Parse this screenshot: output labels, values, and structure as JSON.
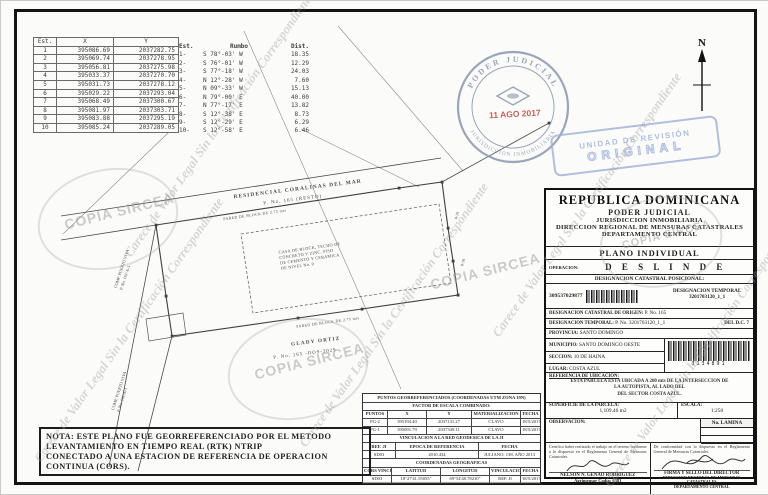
{
  "watermark": {
    "copia": "COPIA SIRCEA",
    "legal": "Carece de Valor Legal Sin la Certificación Correspondiente"
  },
  "north_label": "N",
  "coord_table": {
    "headers": [
      "Est.",
      "X",
      "Y"
    ],
    "rows": [
      [
        "1",
        "395086.69",
        "2037282.75"
      ],
      [
        "2",
        "395069.74",
        "2037278.95"
      ],
      [
        "3",
        "395056.81",
        "2037275.98"
      ],
      [
        "4",
        "395033.37",
        "2037270.70"
      ],
      [
        "5",
        "395031.73",
        "2037278.12"
      ],
      [
        "6",
        "395029.22",
        "2037293.04"
      ],
      [
        "7",
        "395068.49",
        "2037300.67"
      ],
      [
        "8",
        "395081.97",
        "2037303.71"
      ],
      [
        "9",
        "395083.88",
        "2037295.19"
      ],
      [
        "10",
        "395085.24",
        "2037289.05"
      ]
    ]
  },
  "bearing_table": {
    "headers": [
      "Est.",
      "Rumbo",
      "Dist."
    ],
    "rows": [
      [
        "1-",
        "S 78°-03' W",
        "18.35"
      ],
      [
        "2-",
        "S 76°-01' W",
        "12.29"
      ],
      [
        "3-",
        "S 77°-18' W",
        "24.03"
      ],
      [
        "4-",
        "N 12°-28' W",
        "7.60"
      ],
      [
        "5-",
        "N 09°-33' W",
        "15.13"
      ],
      [
        "6-",
        "N 79°-00' E",
        "40.00"
      ],
      [
        "7-",
        "N 77°-17' E",
        "13.82"
      ],
      [
        "8-",
        "S 12°-38' E",
        "8.73"
      ],
      [
        "9-",
        "S 12°-29' E",
        "6.29"
      ],
      [
        "10-",
        "S 12°-58' E",
        "6.46"
      ]
    ]
  },
  "stamps": {
    "round_top": "PODER JUDICIAL",
    "round_bottom": "JURISDICCION INMOBILIARIA",
    "round_date": "11 AGO 2017",
    "revision_line1": "UNIDAD DE REVISIÓN",
    "revision_line2": "ORIGINAL"
  },
  "drawing": {
    "residencial": "RESIDENCIAL CORALINAS DEL MAR",
    "resto": "P. No. 165 (RESTO)",
    "pared_top": "PARED DE BLOCK DE 2.75 mts",
    "pared_bottom": "PARED DE BLOCK DE 2.75 mts",
    "casa_lines": [
      "CASA DE BLOCK, TECHO DE",
      "CONCRETO Y ZINC, PISO",
      "DE CEMENTO Y CERAMICA",
      "DE NIVEL No. 0"
    ],
    "owner": "GLADY ORTIZ",
    "owner_parcel": "P. No. 165 -DOS-3029",
    "neighbor1": "COMP. PUERTO VIVA",
    "neighbor1_parcel": "P. No. 161-A-3",
    "neighbor2": "COMP. PUERTO VIVA",
    "neighbor2_parcel": "P. No. 161-A-1",
    "vertex1": "8-18",
    "vertex2": "8-19"
  },
  "panel": {
    "header_lines": [
      "REPUBLICA  DOMINICANA",
      "PODER  JUDICIAL",
      "JURISDICCION INMOBILIARIA",
      "DIRECCION REGIONAL DE MENSURAS CATASTRALES",
      "DEPARTAMENTO CENTRAL"
    ],
    "plano": "PLANO INDIVIDUAL",
    "operacion_label": "OPERACION:",
    "operacion_value": "D E S L I N D E",
    "desig_pos_label": "DESIGNACION CATASTRAL POSICIONAL:",
    "desig_pos_number": "309537029877",
    "desig_temp_label": "DESIGNACION TEMPORAL",
    "desig_temp_value": "3201703120_1_1",
    "origen_label": "DESIGNACION CATASTRAL DE ORIGEN:",
    "origen_value": "P. No. 165",
    "temporal_label": "DESIGNACION TEMPORAL:",
    "temporal_value": "P. No. 3201703120_1_1",
    "temporal_extra": "DEL D.C. 7",
    "provincia_label": "PROVINCIA:",
    "provincia_value": "SANTO DOMINGO",
    "municipio_label": "MUNICIPIO:",
    "municipio_value": "SANTO DOMINGO OESTE",
    "barcode_number": "3134891",
    "seccion_label": "SECCION:",
    "seccion_value": "10 DE HAINA",
    "lugar_label": "LUGAR:",
    "lugar_value": "COSTA AZUL",
    "referencia_label": "REFERENCIA DE UBICACION:",
    "referencia_lines": [
      "ESTA PARCELA ESTA UBICADA A 200 mts DE LA INTERSECCION DE",
      "LA AUTOPISTA, AL LADO DEL",
      "DEL SECTOR COSTA AZUL."
    ],
    "superficie_label": "SUPERFICIE DE LA PARCELA:",
    "superficie_value": "1,109.46 m2",
    "escala_label": "ESCALA:",
    "escala_value": "1:250",
    "observacion_label": "OBSERVACION:",
    "lamina_label": "No. LAMINA",
    "cert_left_text": "Certifico haber realizado el trabajo en el terreno conforme a lo dispuesto en el Reglamento General de Mensuras Catastrales",
    "cert_left_name": "NELSON N. GENAO RODRIGUEZ",
    "cert_left_sub": "Agrimensor Codia: 6383",
    "cert_right_text": "De conformidad con lo dispuesto en el Reglamento General de Mensuras Catastrales",
    "cert_right_line1": "FIRMA Y SELLO DEL DIRECTOR",
    "cert_right_line2": "DIRECCION REGIONAL DE MENSURAS CATASTRALES",
    "cert_right_line3": "DEPARTAMENTO CENTRAL"
  },
  "georef": {
    "title": "PUNTOS GEORREFERENCIADOS (COORDENADAS UTM ZONA 19N)",
    "factor_label": "FACTOR DE ESCALA COMBINADO:",
    "headers": [
      "PUNTOS",
      "X",
      "Y",
      "MATERIALIZACION",
      "FECHA"
    ],
    "rows": [
      [
        "PG-2",
        "395194.40",
        "2037131.27",
        "CLAVO",
        "18/5/2017"
      ],
      [
        "PG-1",
        "395091.79",
        "2037349.11",
        "CLAVO",
        "18/5/2017"
      ]
    ],
    "vinc_title": "VINCULACION A LA RED GEODESICA DE LA JI",
    "vinc_headers": [
      "REF. JI",
      "EPOCA DE REFERENCIA",
      "FECHA"
    ],
    "vinc_row": [
      "SD03",
      "2010.434",
      "JULIANO, 138, AÑO 2013"
    ],
    "geo_title": "COORDENADAS GEOGRAFICAS",
    "geo_headers": [
      "CORS VINCULADA",
      "LATITUD",
      "LONGITUD",
      "VINCULACION",
      "FECHA"
    ],
    "geo_row": [
      "SD03",
      "18°27'41.55055\"",
      "69°54'48.78210\"",
      "REF. JI",
      "18/5/2017"
    ]
  },
  "nota": {
    "lines": [
      "NOTA: ESTE PLANO FUE GEORREFERENCIADO POR EL METODO",
      "LEVANTAMIENTO EN TIEMPO REAL (RTK) NTRIP",
      "CONECTADO A UNA ESTACION DE REFERENCIA DE OPERACION",
      "CONTINUA (CORS)."
    ]
  }
}
